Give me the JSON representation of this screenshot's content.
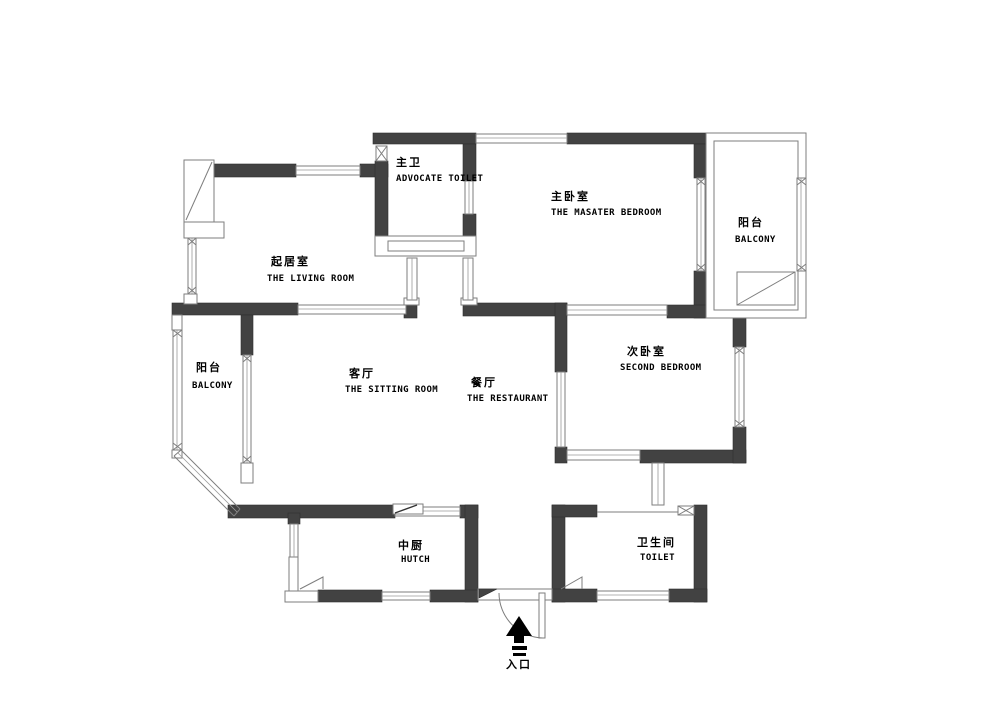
{
  "plan": {
    "type": "apartment-floor-plan",
    "colors": {
      "wall": "#424242",
      "outline": "#7e7e7e",
      "text": "#000000",
      "arrow": "#000000",
      "background": "#ffffff"
    },
    "rooms": [
      {
        "key": "advocate-toilet",
        "zh": "主卫",
        "en": "ADVOCATE TOILET"
      },
      {
        "key": "master-bedroom",
        "zh": "主卧室",
        "en": "THE MASATER BEDROOM"
      },
      {
        "key": "balcony-right",
        "zh": "阳台",
        "en": "BALCONY"
      },
      {
        "key": "living-room",
        "zh": "起居室",
        "en": "THE LIVING ROOM"
      },
      {
        "key": "balcony-left",
        "zh": "阳台",
        "en": "BALCONY"
      },
      {
        "key": "sitting-room",
        "zh": "客厅",
        "en": "THE SITTING ROOM"
      },
      {
        "key": "restaurant",
        "zh": "餐厅",
        "en": "THE RESTAURANT"
      },
      {
        "key": "second-bedroom",
        "zh": "次卧室",
        "en": "SECOND BEDROOM"
      },
      {
        "key": "hutch",
        "zh": "中厨",
        "en": "HUTCH"
      },
      {
        "key": "toilet",
        "zh": "卫生间",
        "en": "TOILET"
      }
    ],
    "entrance": {
      "label": "入口"
    }
  }
}
